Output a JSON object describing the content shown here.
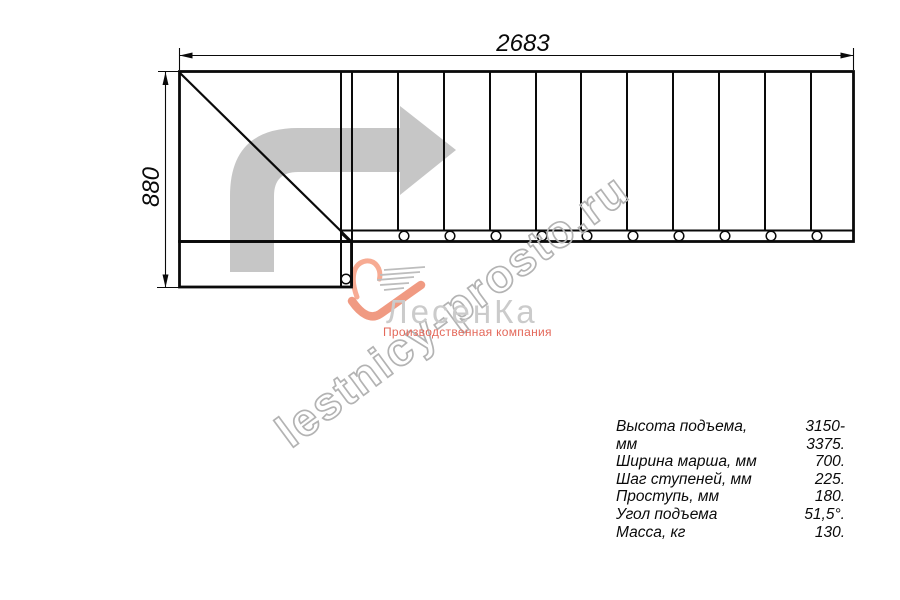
{
  "drawing": {
    "dim_width": "2683",
    "dim_height": "880"
  },
  "watermark": {
    "text": "lestnicy-prosto.ru"
  },
  "logo": {
    "name": "ЛесенКа",
    "subtitle": "Производственная компания"
  },
  "specs": {
    "rows": [
      {
        "label": "Высота подъема, мм",
        "value": "3150-3375."
      },
      {
        "label": "Ширина марша, мм",
        "value": "700."
      },
      {
        "label": "Шаг ступеней, мм",
        "value": "225."
      },
      {
        "label": "Проступь, мм",
        "value": "180."
      },
      {
        "label": "Угол подъема",
        "value": "51,5°."
      },
      {
        "label": "Масса, кг",
        "value": "130."
      }
    ]
  },
  "icons": {
    "direction_arrow": "curved-right-arrow",
    "logo_mark": "heart-stairs"
  },
  "colors": {
    "line": "#0a0a0a",
    "arrow_gray": "#c6c6c6",
    "watermark_gray": "#b3b3b3",
    "logo_gray": "#cbcbcb",
    "logo_red": "#e4685a",
    "heart_salmon": "#f2a089"
  }
}
